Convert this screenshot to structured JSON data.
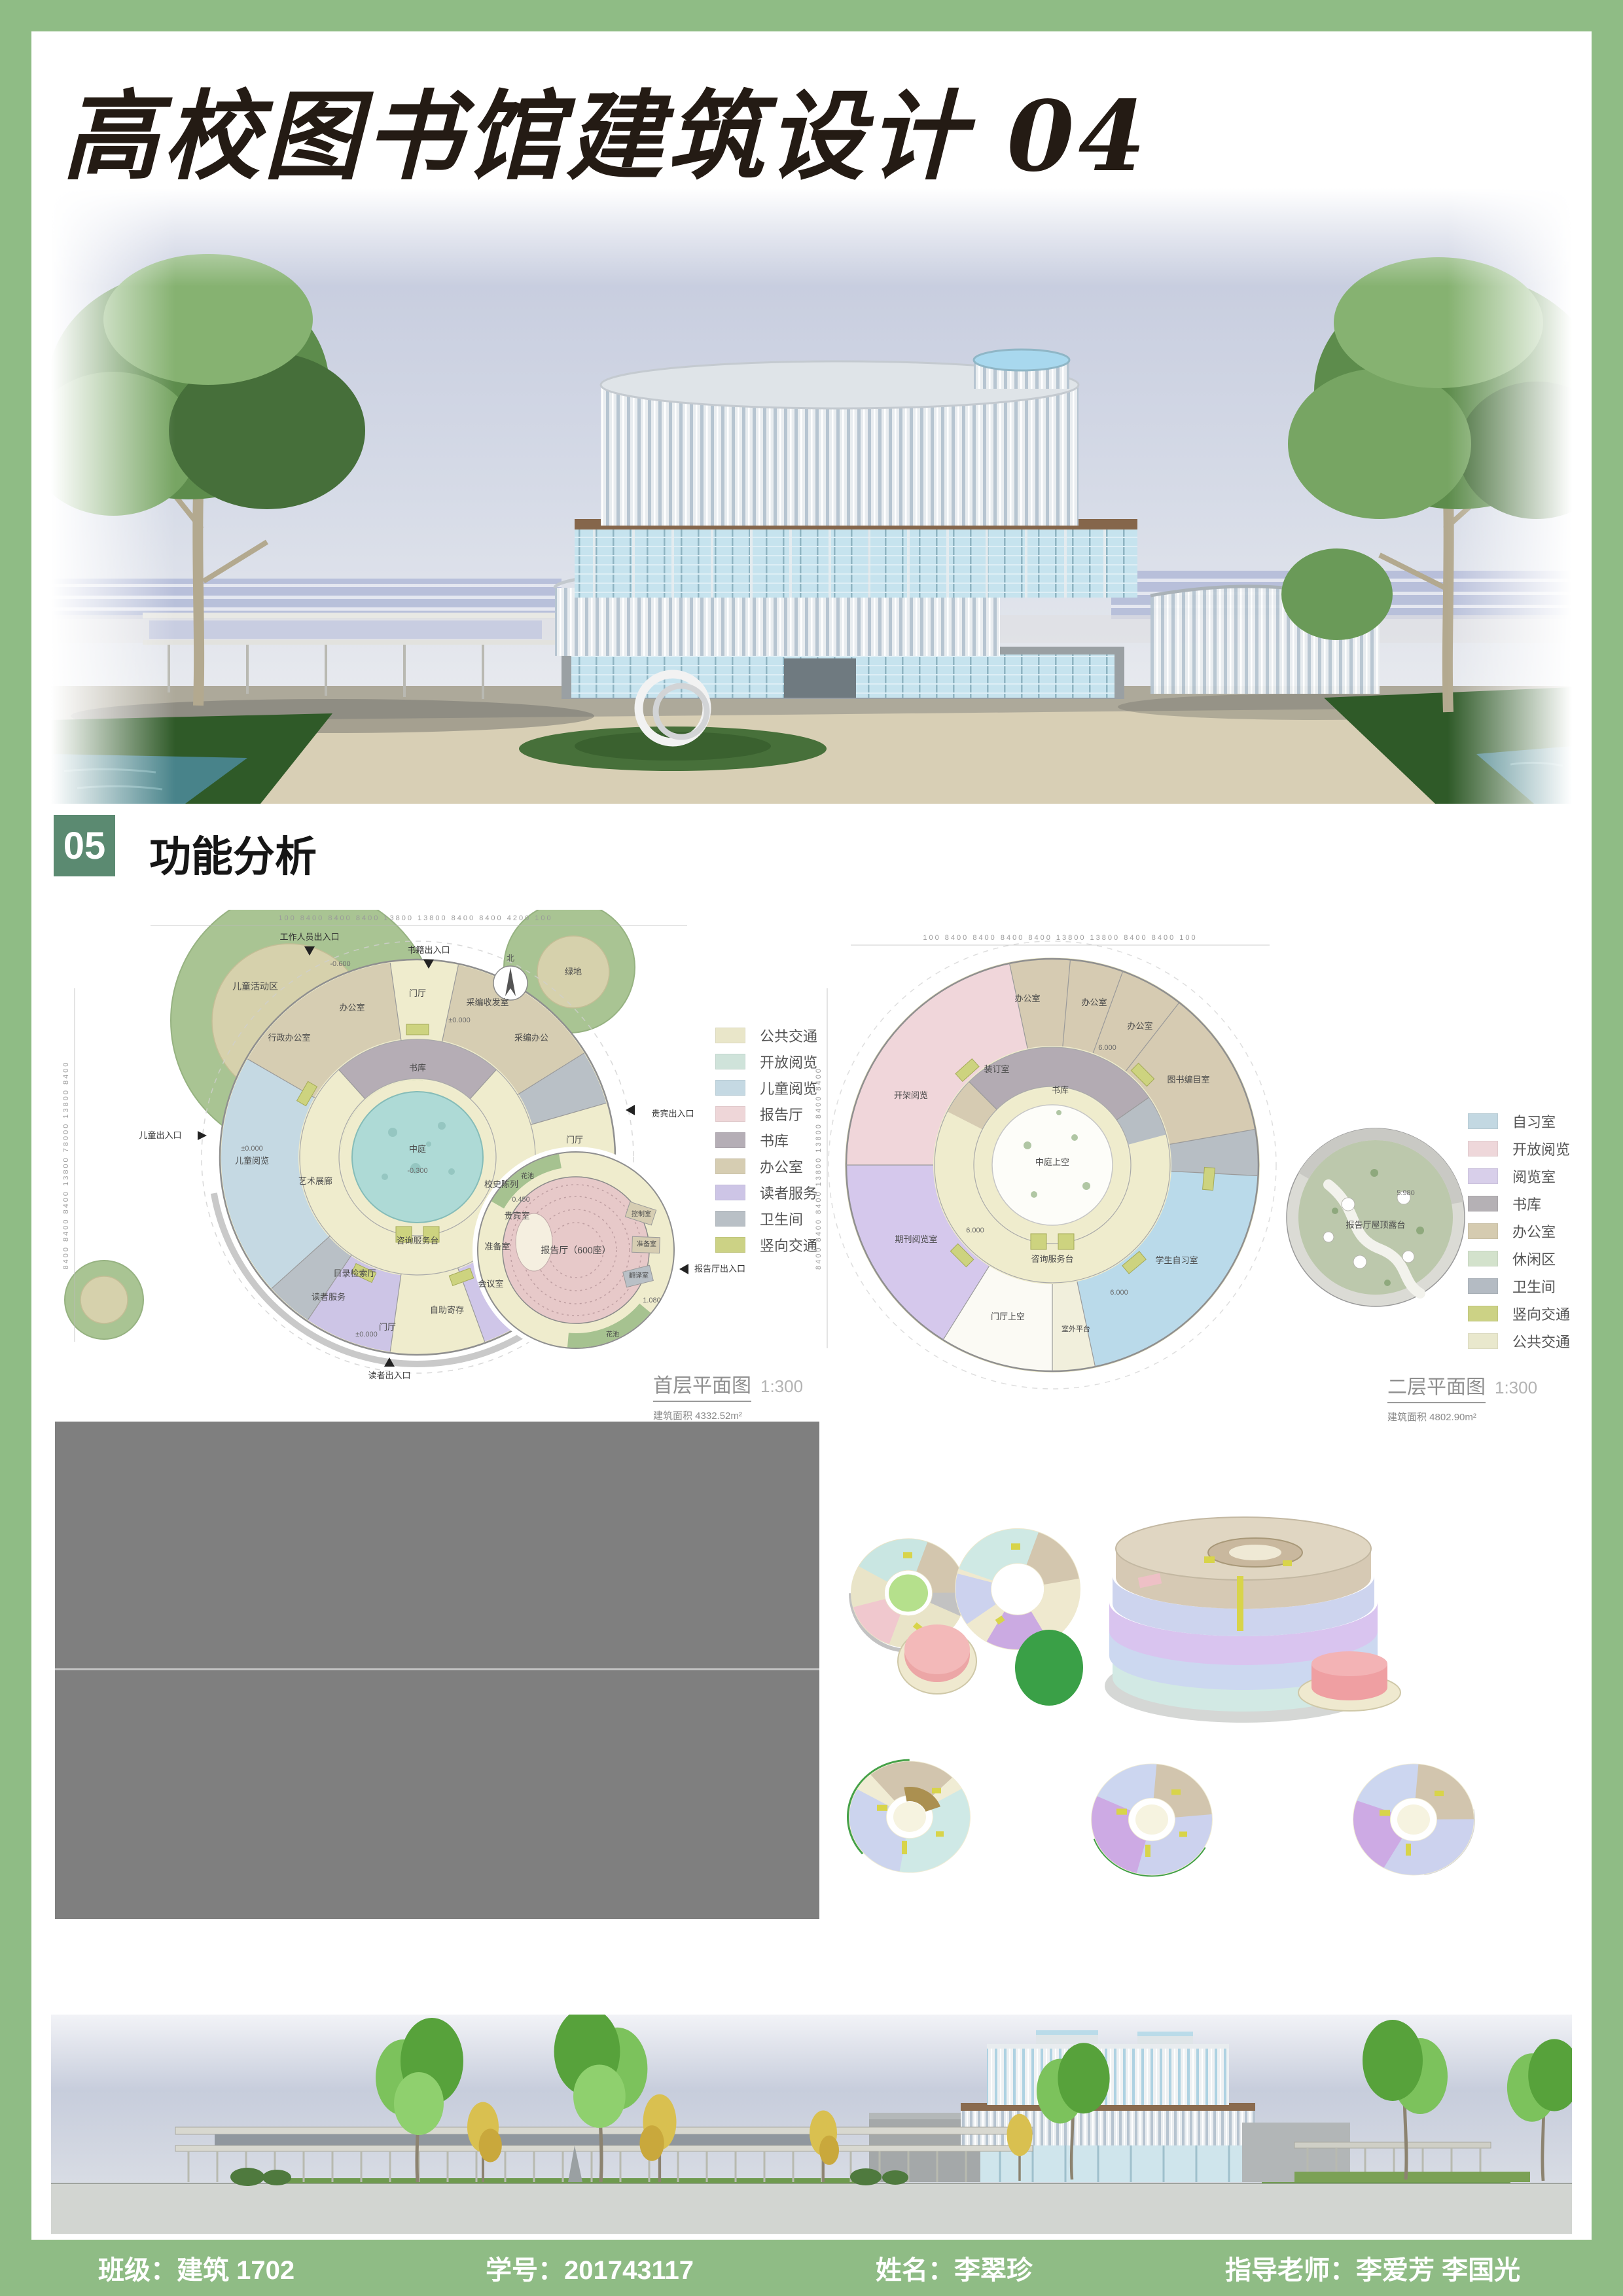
{
  "page": {
    "title": "高校图书馆建筑设计 04"
  },
  "section": {
    "number": "05",
    "title": "功能分析"
  },
  "plan1": {
    "caption": "首层平面图",
    "scale": "1:300",
    "area": "建筑面积  4332.52m²",
    "dims_top": "100   8400   8400   8400   13800   13800   8400   8400   4200   100",
    "dims_left": "8400   8400   8400   13800   78000   13800   8400",
    "north_label": "北",
    "legend": [
      {
        "label": "公共交通",
        "color": "#e9e6c9"
      },
      {
        "label": "开放阅览",
        "color": "#cfe3da"
      },
      {
        "label": "儿童阅览",
        "color": "#c5d9e3"
      },
      {
        "label": "报告厅",
        "color": "#eed6d8"
      },
      {
        "label": "书库",
        "color": "#b5aeb6"
      },
      {
        "label": "办公室",
        "color": "#d6cdb2"
      },
      {
        "label": "读者服务",
        "color": "#cdc5e6"
      },
      {
        "label": "卫生间",
        "color": "#b9c0c6"
      },
      {
        "label": "竖向交通",
        "color": "#ccd285"
      }
    ],
    "rooms": {
      "atrium": "中庭",
      "stack": "书库",
      "lobby_top": "门厅",
      "office": "办公室",
      "admin_office": "行政办公室",
      "acq_mail": "采编收发室",
      "acq_office": "采编办公",
      "lobby_right": "门厅",
      "vip": "贵宾室",
      "prep": "准备室",
      "meeting": "会议室",
      "locker": "自助寄存",
      "lobby_bottom": "门厅",
      "catalog": "目录检索厅",
      "reader_service": "读者服务",
      "info_desk": "咨询服务台",
      "gallery": "艺术展廊",
      "children": "儿童阅览",
      "history": "校史陈列",
      "lecture": "报告厅（600座）",
      "control": "控制室",
      "prep2": "准备室",
      "translate": "翻译室",
      "flower1": "花池",
      "flower2": "花池",
      "site_children": "儿童活动区",
      "site_green": "绿地"
    },
    "entrances": {
      "staff": "工作人员出入口",
      "books": "书籍出入口",
      "vip": "贵宾出入口",
      "lecture": "报告厅出入口",
      "reader": "读者出入口",
      "children": "儿童出入口"
    },
    "levels": {
      "l0a": "±0.000",
      "l0b": "±0.000",
      "l0c": "±0.000",
      "lm03": "-0.300",
      "lm06": "-0.600",
      "l045": "0.450",
      "l108": "1.080"
    }
  },
  "plan2": {
    "caption": "二层平面图",
    "scale": "1:300",
    "area": "建筑面积  4802.90m²",
    "dims_top": "100   8400   8400   8400   8400   13800   13800   8400   8400   100",
    "dims_left": "8400   8400   8400   13800   13800   8400   8400",
    "legend": [
      {
        "label": "自习室",
        "color": "#c3d8e2"
      },
      {
        "label": "开放阅览",
        "color": "#eed7da"
      },
      {
        "label": "阅览室",
        "color": "#d8cfea"
      },
      {
        "label": "书库",
        "color": "#b5b1b5"
      },
      {
        "label": "办公室",
        "color": "#d5cbb0"
      },
      {
        "label": "休闲区",
        "color": "#d3e2cc"
      },
      {
        "label": "卫生间",
        "color": "#b4bbc3"
      },
      {
        "label": "竖向交通",
        "color": "#ccd285"
      },
      {
        "label": "公共交通",
        "color": "#e9e8cd"
      }
    ],
    "rooms": {
      "void": "中庭上空",
      "stack": "书库",
      "office1": "办公室",
      "office2": "办公室",
      "office3": "办公室",
      "binding": "装订室",
      "catalog_office": "图书编目室",
      "open_reading": "开架阅览",
      "periodicals": "期刊阅览室",
      "study": "学生自习室",
      "info_desk": "咨询服务台",
      "lobby_void": "门厅上空",
      "terrace_small": "室外平台",
      "roof_terrace": "报告厅屋顶露台"
    },
    "levels": {
      "l6a": "6.000",
      "l6b": "6.000",
      "l6c": "6.000",
      "l598": "5.980"
    }
  },
  "footer": {
    "class_label": "班级：",
    "class_value": "建筑 1702",
    "student_id_label": "学号：",
    "student_id_value": "201743117",
    "name_label": "姓名：",
    "name_value": "李翠珍",
    "advisor_label": "指导老师：",
    "advisor_value": "李爱芳 李国光"
  },
  "colors": {
    "frame_green": "#8fbc85",
    "section_green": "#5b8a71",
    "placeholder_gray": "#7f7f7f"
  }
}
